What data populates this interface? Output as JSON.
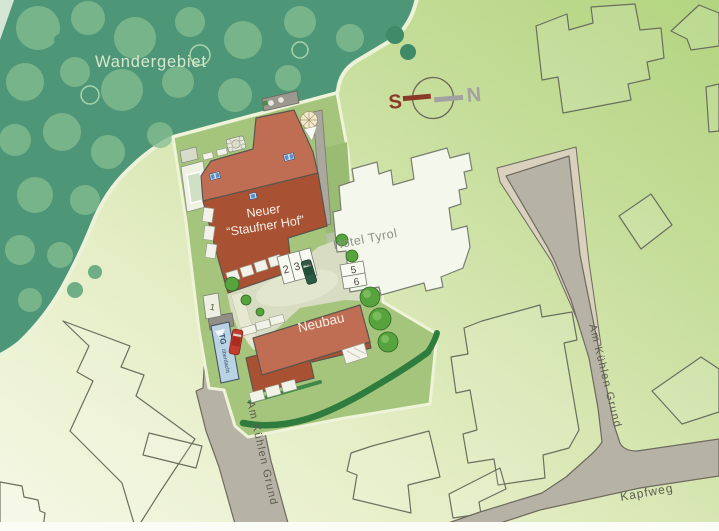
{
  "map": {
    "area_label": "Wandergebiet",
    "main_building": {
      "line1": "Neuer",
      "line2": "“Staufner Hof”"
    },
    "neighbor_building": "Hotel Tyrol",
    "new_building": "Neubau",
    "streets": {
      "left": "Am Kühlen Grund",
      "right": "Am Kühlen Grund",
      "bottom": "Kapfweg"
    },
    "garage_ramp": {
      "abbr": "TG",
      "note": "überdacht"
    },
    "compass": {
      "south": "S",
      "north": "N"
    },
    "parking_spaces": [
      "1",
      "2",
      "3",
      "4",
      "5",
      "6"
    ],
    "colors": {
      "forest": "#4e9678",
      "forest_trees": "#85bd90",
      "lawn_light": "#f6f8e6",
      "lawn_dark": "#b2d47f",
      "parcel": "#a6c57c",
      "building_light": "#c06e53",
      "building_dark": "#a85233",
      "hotel_fill": "#f4f7ec",
      "road": "#b6b2a6",
      "parking_border": "#d9d0bd",
      "ramp_blue": "#bad3e4",
      "hedge": "#2e7c3e",
      "compass_south": "#8a3a28",
      "compass_north": "#a3a2a0",
      "car_red": "#c23b2e",
      "car_green": "#2c5c43"
    }
  }
}
